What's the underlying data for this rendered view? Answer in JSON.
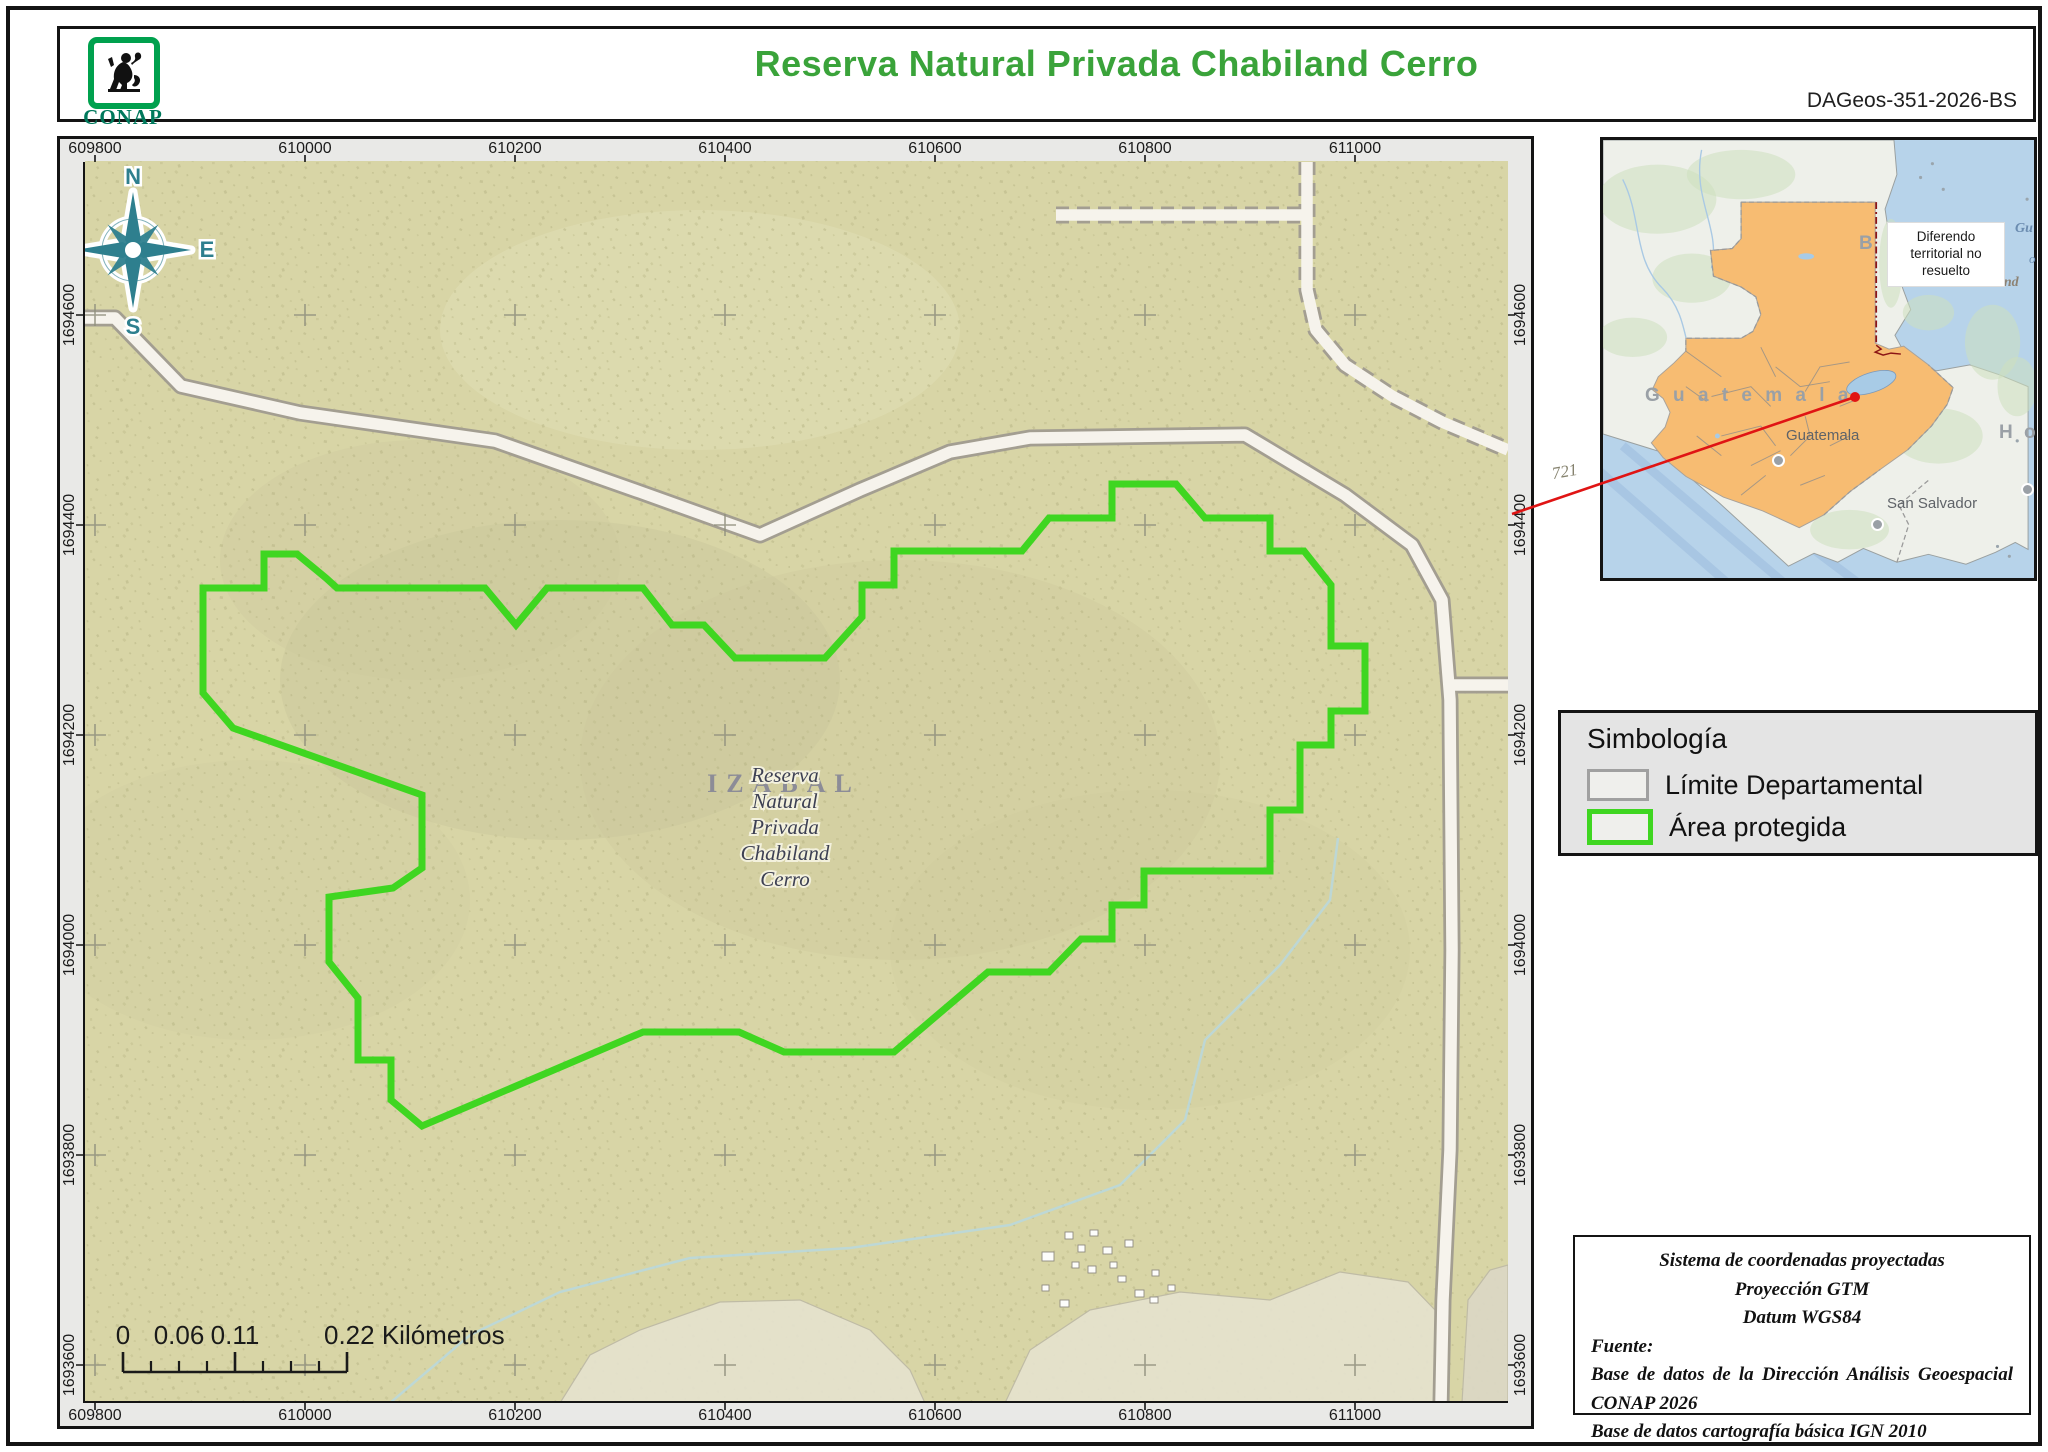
{
  "header": {
    "title": "Reserva Natural Privada Chabiland Cerro",
    "doc_id": "DAGeos-351-2026-BS",
    "logo_text": "CONAP"
  },
  "colors": {
    "accent_green": "#3aa33a",
    "protected_area": "#3fd621",
    "limite_gray": "#a0a0a0",
    "map_bg": "#d8d5a6",
    "speckle": "#b2af7e",
    "road_fill": "#f6f3ec",
    "road_casing": "#a39e91",
    "grid_cross": "#8f8f7d",
    "water_inset": "#b7d3ea",
    "land_inset": "#eef0ea",
    "guatemala_fill": "#f7bc72",
    "red_annotation": "#e01414",
    "red_border": "#8b1515",
    "compass": "#2e7f8e",
    "stream": "#b9d8de"
  },
  "map": {
    "xticks": [
      {
        "label": "609800",
        "x": 95
      },
      {
        "label": "610000",
        "x": 305
      },
      {
        "label": "610200",
        "x": 515
      },
      {
        "label": "610400",
        "x": 725
      },
      {
        "label": "610600",
        "x": 935
      },
      {
        "label": "610800",
        "x": 1145
      },
      {
        "label": "611000",
        "x": 1355
      }
    ],
    "yticks": [
      {
        "label": "1694600",
        "y": 315
      },
      {
        "label": "1694400",
        "y": 525
      },
      {
        "label": "1694200",
        "y": 735
      },
      {
        "label": "1694000",
        "y": 945
      },
      {
        "label": "1693800",
        "y": 1155
      },
      {
        "label": "1693600",
        "y": 1365
      }
    ],
    "compass": {
      "cx": 133,
      "cy": 250,
      "n": "N",
      "e": "E",
      "s": "S",
      "o": "O"
    },
    "region_label": "IZABAL",
    "place_label_lines": [
      "Reserva",
      "Natural",
      "Privada",
      "Chabiland",
      "Cerro"
    ],
    "place_label_center": {
      "x": 785,
      "y": 782,
      "line_step": 26
    },
    "polygon": "203,588 264,588 264,554 297,554 326,578 337,588 485,588 516,625 547,588 643,588 672,625 704,625 735,658 825,658 862,617 862,585 894,585 894,551 1022,551 1049,518 1112,518 1112,484 1176,484 1205,518 1270,518 1270,551 1304,551 1331,585 1331,646 1365,646 1365,711 1331,711 1331,745 1300,745 1300,810 1270,810 1270,871 1144,871 1144,905 1112,905 1112,939 1081,939 1049,972 988,972 894,1052 784,1052 739,1032 643,1032 422,1126 391,1100 391,1060 358,1060 358,998 329,962 329,897 393,888 422,868 422,795 233,728 203,693",
    "roads": [
      {
        "points": "83,318 115,318 181,386 300,413 495,441 640,492 760,535 860,490 950,452 1030,438 1245,435 1345,495 1412,545 1442,600 1450,700 1452,950 1450,1150 1443,1300 1441,1403",
        "dashed": false
      },
      {
        "points": "1452,685 1508,685",
        "dashed": false
      },
      {
        "points": "1307,162 1307,290 1316,330 1345,365 1392,396 1442,422 1508,450",
        "dashed": true
      },
      {
        "points": "1056,215 1307,215",
        "dashed": true
      }
    ],
    "streams": [
      "390,1403 470,1335 560,1292 690,1258 850,1248 1010,1225 1120,1185 1185,1120 1205,1040 1280,965 1330,900 1338,838"
    ],
    "buildings": [
      [
        1042,
        1252,
        12,
        9
      ],
      [
        1065,
        1232,
        8,
        7
      ],
      [
        1078,
        1245,
        7,
        7
      ],
      [
        1090,
        1230,
        8,
        6
      ],
      [
        1103,
        1247,
        9,
        7
      ],
      [
        1072,
        1262,
        7,
        6
      ],
      [
        1088,
        1266,
        8,
        7
      ],
      [
        1110,
        1262,
        7,
        6
      ],
      [
        1125,
        1240,
        8,
        7
      ],
      [
        1118,
        1276,
        8,
        6
      ],
      [
        1135,
        1290,
        9,
        7
      ],
      [
        1152,
        1270,
        7,
        6
      ],
      [
        1150,
        1297,
        8,
        6
      ],
      [
        1168,
        1285,
        7,
        6
      ],
      [
        1060,
        1300,
        9,
        7
      ],
      [
        1042,
        1285,
        7,
        6
      ]
    ],
    "patches": [
      {
        "points": "560,1403 590,1355 640,1330 720,1302 800,1300 870,1330 910,1370 925,1403",
        "fill": "#e6e3cf"
      },
      {
        "points": "1005,1403 1030,1350 1090,1310 1180,1292 1270,1300 1340,1272 1408,1282 1435,1310 1438,1403",
        "fill": "#e6e3cf"
      },
      {
        "points": "1462,1403 1468,1300 1490,1270 1508,1265 1508,1403",
        "fill": "#dcd8c6"
      }
    ],
    "hills": [
      [
        560,
        680,
        280,
        160,
        "#c6c397",
        0.35
      ],
      [
        420,
        560,
        200,
        120,
        "#cbc89b",
        0.3
      ],
      [
        900,
        760,
        320,
        200,
        "#c9c69a",
        0.28
      ],
      [
        700,
        330,
        260,
        120,
        "#e2dfb8",
        0.45
      ],
      [
        1150,
        950,
        260,
        160,
        "#cdc99c",
        0.22
      ],
      [
        250,
        900,
        220,
        140,
        "#cdca9e",
        0.2
      ]
    ],
    "scalebar": {
      "labels": [
        {
          "text": "0",
          "x": 123,
          "anchor": "middle"
        },
        {
          "text": "0.06",
          "x": 179,
          "anchor": "middle"
        },
        {
          "text": "0.11",
          "x": 235,
          "anchor": "middle"
        },
        {
          "text": "0.22 Kilómetros",
          "x": 324,
          "anchor": "start"
        }
      ],
      "x0": 123,
      "x1": 347,
      "y": 1372,
      "ticks_major": [
        123,
        235,
        347
      ],
      "ticks_minor": [
        151,
        179,
        207,
        263,
        291,
        319
      ]
    }
  },
  "inset": {
    "land": "0,0 295,0 298,35 286,70 292,110 303,148 312,172 296,198 309,222 338,234 372,228 402,238 431,250 431,415 418,408 398,418 368,430 330,420 298,428 264,414 238,428 214,419 188,432 118,368 58,316 0,298",
    "guatemala": "140,63 276,63 276,206 290,212 305,209 330,228 355,251 349,268 333,290 309,314 281,334 251,356 224,380 199,393 162,376 122,362 84,341 61,322 49,307 63,291 68,276 61,262 50,253 56,240 72,226 84,214 84,201 140,201 152,194 160,177 155,159 140,149 112,138 109,112 131,110 140,100",
    "red_dashdot": "M277,63 L277,208",
    "red_zigzag": "277,208 282,212 276,215 284,218 292,216 302,217",
    "labels": {
      "country": "G u a t e m a l a",
      "city": "Guatemala",
      "san_salvador": "San Salvador",
      "honduras_frag": "H o",
      "belize_frag": "B",
      "gulf_frag1": "Gu",
      "gulf_frag2": "o",
      "gulf_frag3": "Hond",
      "diferendo": "Diferendo territorial no resuelto"
    }
  },
  "annotations": {
    "ref_number": "721",
    "red_line": {
      "x1": 1855,
      "y1": 397,
      "x2": 1512,
      "y2": 514
    },
    "red_dot": {
      "x": 1855,
      "y": 397
    }
  },
  "legend": {
    "title": "Simbología",
    "items": [
      {
        "label": "Límite Departamental",
        "border": "#a0a0a0",
        "border_w": 3
      },
      {
        "label": "Área protegida",
        "border": "#3fd621",
        "border_w": 5
      }
    ]
  },
  "info_box": {
    "centered_lines": [
      "Sistema de coordenadas proyectadas",
      "Proyección GTM",
      "Datum WGS84"
    ],
    "fuente_label": "Fuente:",
    "source_line1": "Base de datos de la Dirección Análisis Geoespacial CONAP 2026",
    "source_line2": "Base de datos cartografía básica IGN 2010"
  }
}
